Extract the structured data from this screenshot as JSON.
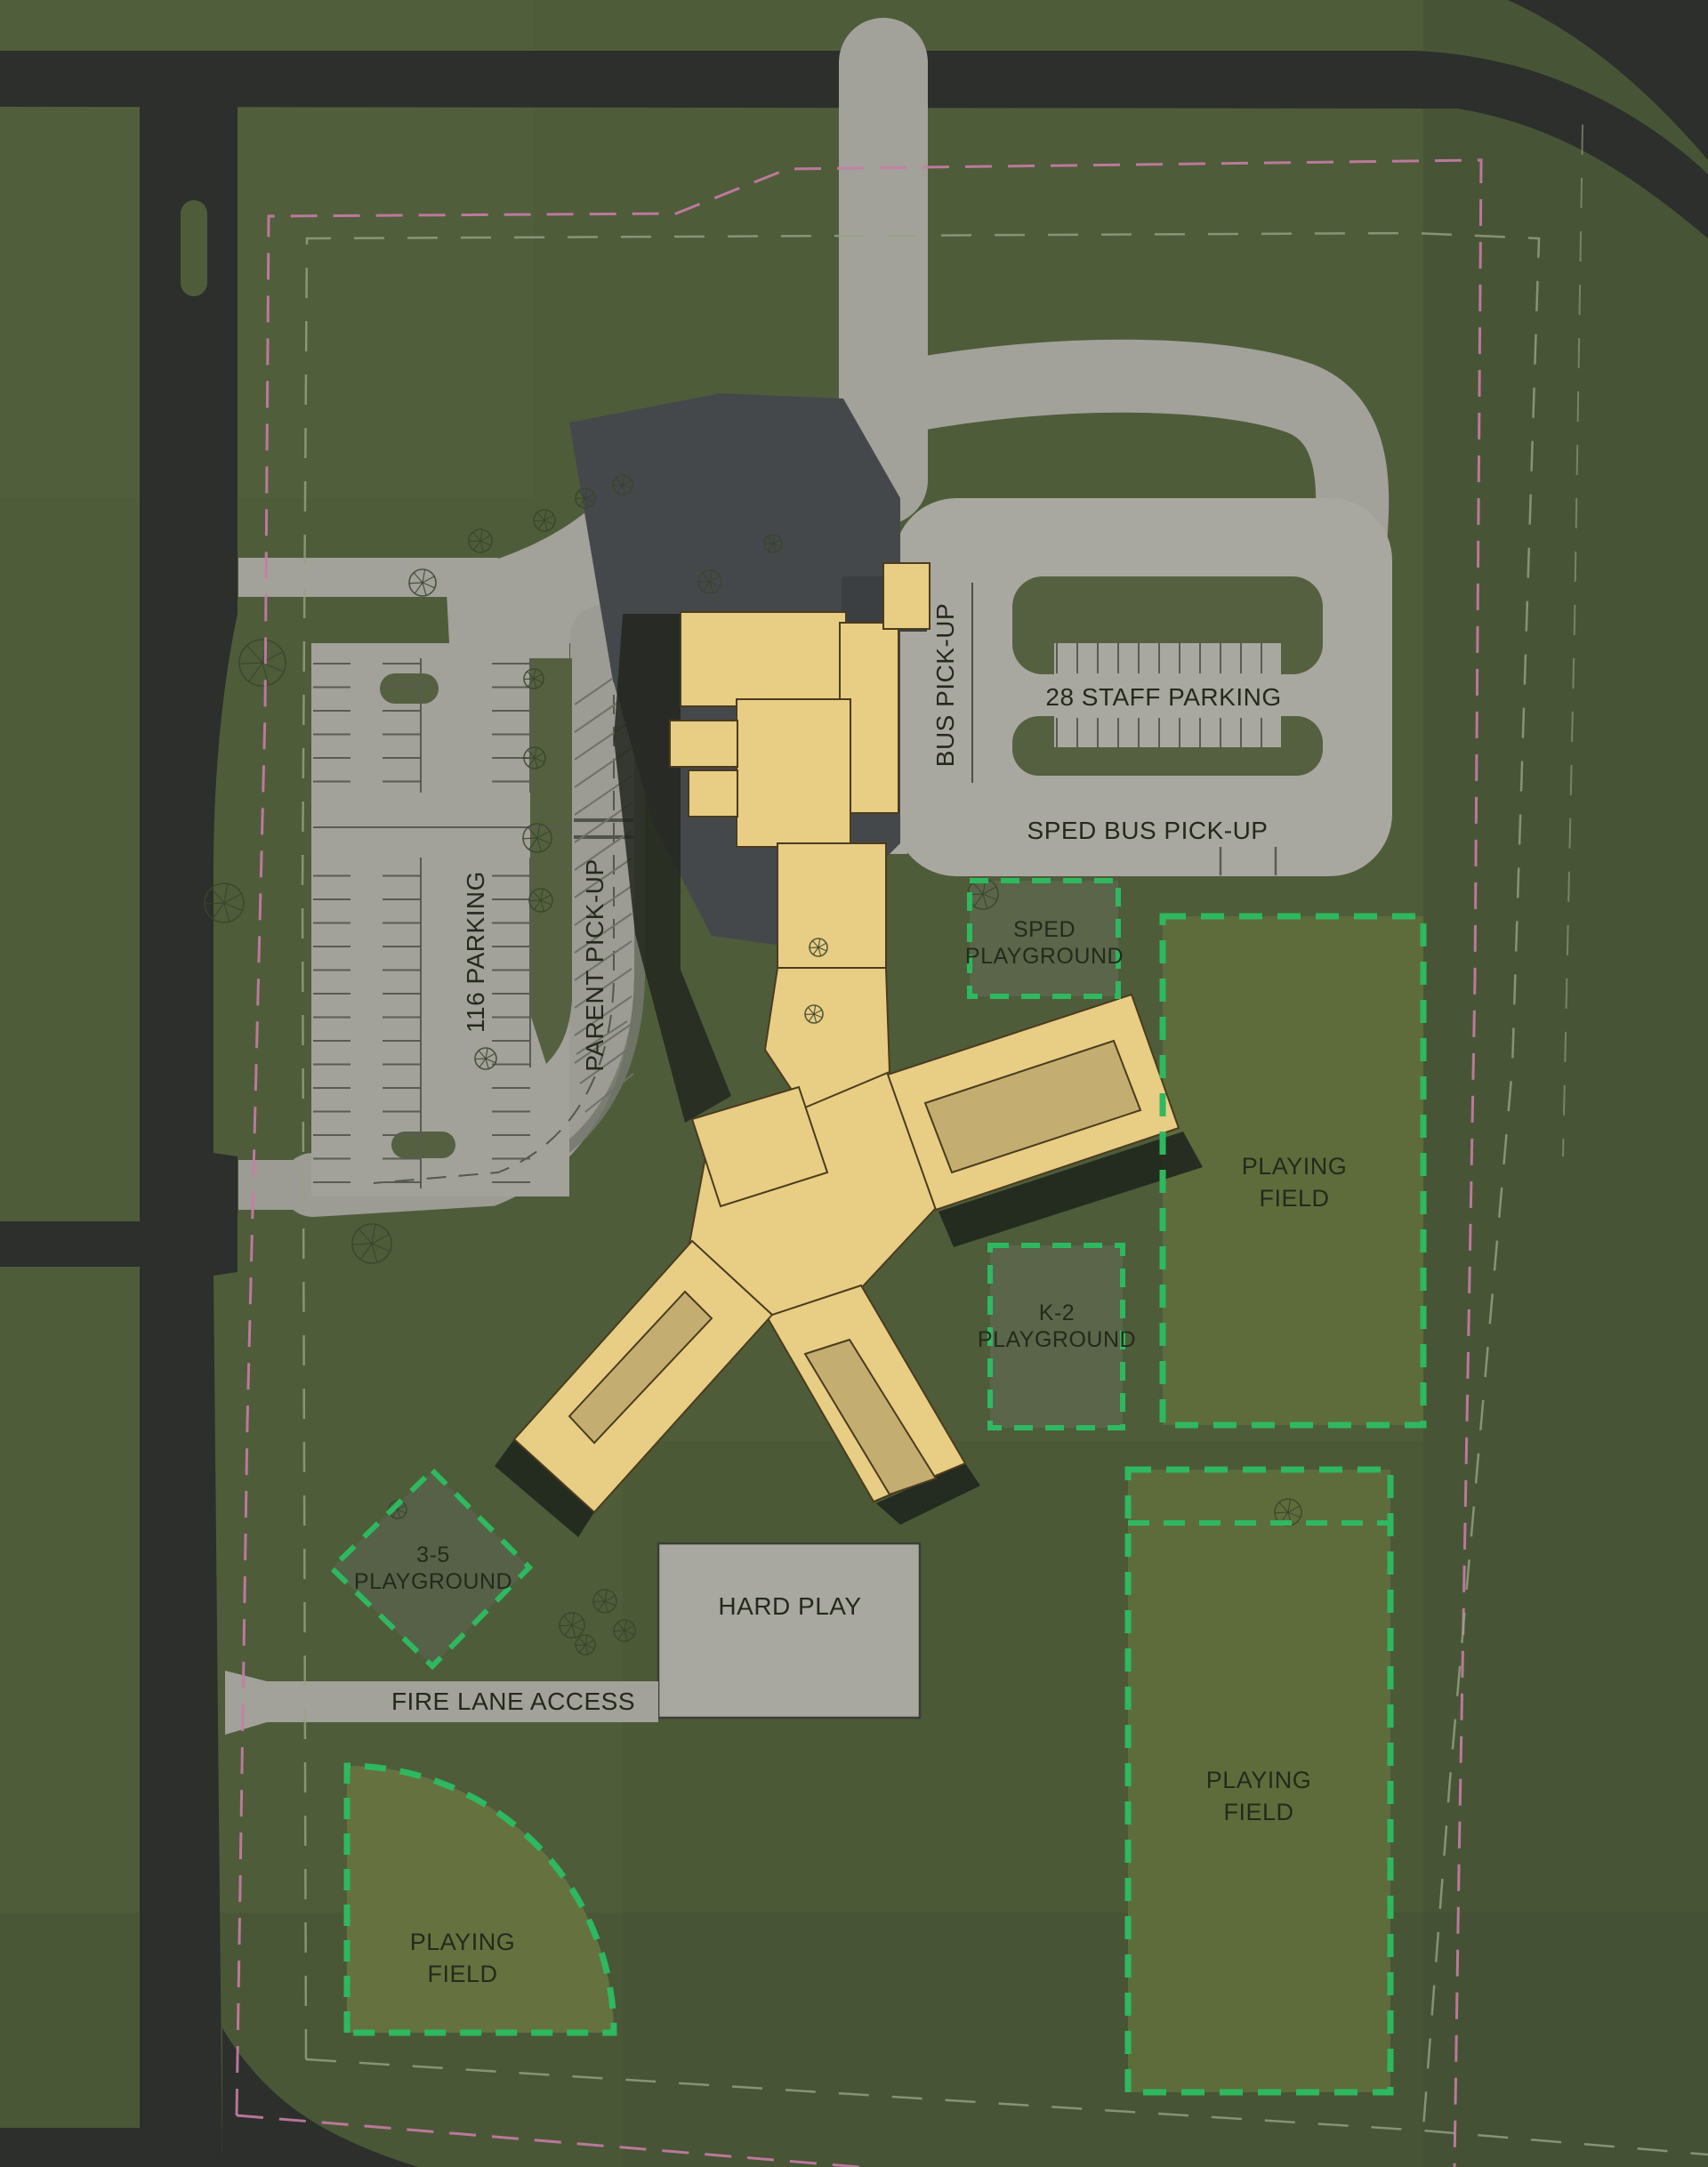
{
  "site_plan": {
    "type": "school-campus-site-plan",
    "labels": {
      "parking_116": "116 PARKING",
      "parent_pickup": "PARENT PICK-UP",
      "bus_pickup": "BUS PICK-UP",
      "staff_parking": "28 STAFF PARKING",
      "sped_bus_pickup": "SPED BUS PICK-UP",
      "sped_playground": {
        "line1": "SPED",
        "line2": "PLAYGROUND"
      },
      "k2_playground": {
        "line1": "K-2",
        "line2": "PLAYGROUND"
      },
      "playground_35": {
        "line1": "3-5",
        "line2": "PLAYGROUND"
      },
      "hard_play": "HARD PLAY",
      "fire_lane": "FIRE LANE ACCESS",
      "playing_field_east": {
        "line1": "PLAYING",
        "line2": "FIELD"
      },
      "playing_field_southeast": {
        "line1": "PLAYING",
        "line2": "FIELD"
      },
      "playing_field_southwest": {
        "line1": "PLAYING",
        "line2": "FIELD"
      }
    },
    "colors": {
      "grass": "#4e5c3a",
      "grass_dark": "#41502f",
      "field_fill": "#5e6c3c",
      "field_fill_bright": "#65723f",
      "playground_fill": "#5a654a",
      "field_dash_green": "#2eb860",
      "road_asphalt": "#2c2f2b",
      "pavement": "#a2a19a",
      "pavement_light": "#aeaca2",
      "plaza_charcoal": "#45484b",
      "shadow": "#1d231c",
      "building_tan": "#e8cd84",
      "building_roof": "#c4ad70",
      "building_outline": "#4a3c1e",
      "stall_line": "#5a5c52",
      "property_line_pink": "#c87ca6",
      "boundary_line_gray": "#97a285",
      "label_text": "#242a1b"
    }
  }
}
